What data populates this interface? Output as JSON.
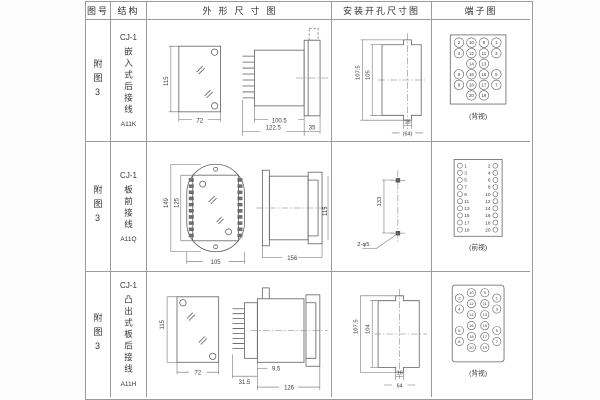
{
  "header": {
    "figure_col": "图号",
    "structure_col": "结构",
    "outline_col": "外形尺寸图",
    "mounting_col": "安装开孔尺寸图",
    "terminal_col": "端子图"
  },
  "rows": [
    {
      "figure": "附图3",
      "structure": {
        "model": "CJ-1",
        "desc": "嵌入式后接线",
        "code": "A11K"
      },
      "outline": {
        "front_height": "115",
        "front_width": "72",
        "body_depth": "100.5",
        "total_depth": "122.5",
        "flange_depth": "35"
      },
      "mounting": {
        "outer_height": "107.5",
        "inner_height": "105",
        "notch_width": "16",
        "cutout_width": "(64)"
      },
      "terminal": {
        "caption": "(背视)",
        "grid": [
          [
            "2",
            "10",
            "9",
            "1"
          ],
          [
            "4",
            "12",
            "11",
            "3"
          ],
          [
            "",
            "14",
            "13",
            ""
          ],
          [
            "6",
            "16",
            "15",
            "5"
          ],
          [
            "8",
            "18",
            "17",
            "7"
          ],
          [
            "",
            "20",
            "19",
            ""
          ]
        ]
      }
    },
    {
      "figure": "附图3",
      "structure": {
        "model": "CJ-1",
        "desc": "板前接线",
        "code": "A11Q"
      },
      "outline": {
        "outer_height": "149",
        "inner_height": "125",
        "front_width": "105",
        "side_length": "156",
        "side_height": "115"
      },
      "mounting": {
        "hole_spacing": "133",
        "hole_label": "2-φ5"
      },
      "terminal": {
        "caption": "(前视)",
        "pairs": [
          [
            "1",
            "2"
          ],
          [
            "3",
            "4"
          ],
          [
            "5",
            "6"
          ],
          [
            "7",
            "8"
          ],
          [
            "9",
            "10"
          ],
          [
            "11",
            "12"
          ],
          [
            "13",
            "14"
          ],
          [
            "15",
            "16"
          ],
          [
            "17",
            "18"
          ],
          [
            "19",
            "20"
          ]
        ]
      }
    },
    {
      "figure": "附图3",
      "structure": {
        "model": "CJ-1",
        "desc": "凸出式板后接线",
        "code": "A11H"
      },
      "outline": {
        "front_height": "115",
        "front_width": "72",
        "stub_depth": "31.5",
        "gap_depth": "9.5",
        "body_depth": "126"
      },
      "mounting": {
        "outer_height": "107.5",
        "inner_height": "104",
        "notch_width": "16",
        "cutout_width": "64"
      },
      "terminal": {
        "caption": "(背视)",
        "grid": [
          [
            "2",
            "10",
            "9",
            "1"
          ],
          [
            "4",
            "12",
            "11",
            "3"
          ],
          [
            "",
            "14",
            "13",
            ""
          ],
          [
            "6",
            "16",
            "15",
            "5"
          ],
          [
            "8",
            "18",
            "17",
            "7"
          ],
          [
            "",
            "20",
            "19",
            ""
          ]
        ]
      }
    }
  ]
}
